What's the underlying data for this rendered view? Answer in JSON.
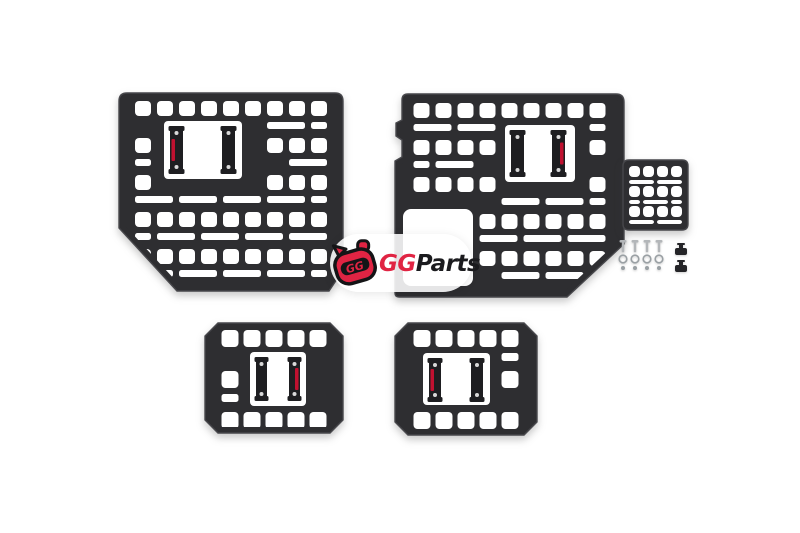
{
  "logo": {
    "gg": "GG",
    "parts": "Parts",
    "mascot_gg": "GG",
    "red": "#e02443",
    "dark": "#1b1b1e"
  },
  "scene": {
    "background": "#ffffff",
    "palette": {
      "panel": "#2e2e31",
      "panel_edge": "#47474b",
      "hole": "#ffffff",
      "bracket": "#1e1e21",
      "screw": "#d9d9d9",
      "label_red": "#c01130",
      "hardware": "#b3b6b9",
      "hardware_ring": "#9aa0a4",
      "hardware_dark": "#242427"
    },
    "panels": [
      {
        "name": "large-molle-panel-left",
        "outline": "M 127 93 L 335 93 Q 343 93 343 101 L 343 270 L 329 291 L 177 291 L 119 228 L 119 101 Q 119 93 127 93 Z",
        "grid": {
          "x": 128,
          "y": 101,
          "w": 206,
          "h": 184,
          "sq_w": 16,
          "sq_h": 15,
          "gap_x": 6,
          "cycle": 37,
          "slat_dy": 21,
          "slat_h": 7,
          "span": 2
        },
        "windows": [
          {
            "x": 164,
            "y": 121,
            "w": 78,
            "h": 58,
            "rx": 4
          }
        ],
        "brackets": [
          {
            "x": 170,
            "y": 126,
            "w": 13,
            "h": 48,
            "label": "left"
          },
          {
            "x": 222,
            "y": 126,
            "w": 13,
            "h": 48
          }
        ]
      },
      {
        "name": "large-molle-panel-right",
        "outline": "M 408 94 L 616 94 Q 624 94 624 102 L 624 244 L 567 297 L 399 297 Q 395 297 395 293 L 395 161 L 402 157 L 402 140 L 396 136 L 396 123 L 402 120 L 402 100 Q 402 94 408 94 Z",
        "grid": {
          "x": 404,
          "y": 103,
          "w": 211,
          "h": 186,
          "sq_w": 16,
          "sq_h": 15,
          "gap_x": 6,
          "cycle": 37,
          "slat_dy": 21,
          "slat_h": 7,
          "span": 2
        },
        "windows": [
          {
            "x": 505,
            "y": 125,
            "w": 70,
            "h": 57,
            "rx": 4
          },
          {
            "x": 403,
            "y": 209,
            "w": 70,
            "h": 77,
            "rx": 8
          }
        ],
        "brackets": [
          {
            "x": 511,
            "y": 130,
            "w": 13,
            "h": 47
          },
          {
            "x": 552,
            "y": 130,
            "w": 13,
            "h": 47,
            "label": "right"
          }
        ]
      },
      {
        "name": "small-molle-panel",
        "outline": "M 629 160 L 682 160 Q 688 160 688 166 L 688 224 Q 688 230 682 230 L 629 230 Q 623 230 623 224 L 623 166 Q 623 160 629 160 Z",
        "grid": {
          "x": 629,
          "y": 166,
          "w": 53,
          "h": 59,
          "sq_w": 11,
          "sq_h": 11,
          "gap_x": 3,
          "cycle": 20,
          "slat_dy": 14,
          "slat_h": 4,
          "span": 2
        },
        "windows": [],
        "brackets": []
      },
      {
        "name": "wheel-well-molle-panel-left",
        "outline": "M 218 323 L 330 323 L 343 336 L 343 420 L 330 433 L 218 433 L 205 420 L 205 336 Z",
        "grid": {
          "x": 214,
          "y": 330,
          "w": 120,
          "h": 100,
          "sq_w": 17,
          "sq_h": 17,
          "gap_x": 5,
          "cycle": 41,
          "slat_dy": 23,
          "slat_h": 8,
          "span": 2
        },
        "windows": [
          {
            "x": 250,
            "y": 352,
            "w": 56,
            "h": 54,
            "rx": 4
          }
        ],
        "brackets": [
          {
            "x": 256,
            "y": 357,
            "w": 11,
            "h": 44
          },
          {
            "x": 289,
            "y": 357,
            "w": 11,
            "h": 44,
            "label": "right"
          }
        ]
      },
      {
        "name": "wheel-well-molle-panel-right",
        "outline": "M 408 323 L 524 323 L 537 336 L 537 422 L 524 435 L 408 435 L 395 422 L 395 336 Z",
        "grid": {
          "x": 404,
          "y": 330,
          "w": 124,
          "h": 102,
          "sq_w": 17,
          "sq_h": 17,
          "gap_x": 5,
          "cycle": 41,
          "slat_dy": 23,
          "slat_h": 8,
          "span": 2
        },
        "windows": [
          {
            "x": 423,
            "y": 353,
            "w": 67,
            "h": 52,
            "rx": 4
          }
        ],
        "brackets": [
          {
            "x": 429,
            "y": 358,
            "w": 12,
            "h": 44,
            "label": "left"
          },
          {
            "x": 471,
            "y": 358,
            "w": 12,
            "h": 44
          }
        ]
      }
    ],
    "hardware": {
      "screws": {
        "xs": [
          623,
          635,
          647,
          659
        ],
        "y": 240,
        "head_w": 7,
        "shaft_h": 10
      },
      "washers": {
        "xs": [
          623,
          635,
          647,
          659
        ],
        "cy": 259,
        "r": 3.8
      },
      "nuts": {
        "xs": [
          623,
          635,
          647,
          659
        ],
        "cy": 268,
        "r": 2
      },
      "tbolts": {
        "cx": 681,
        "ys": [
          244,
          261
        ]
      }
    }
  }
}
